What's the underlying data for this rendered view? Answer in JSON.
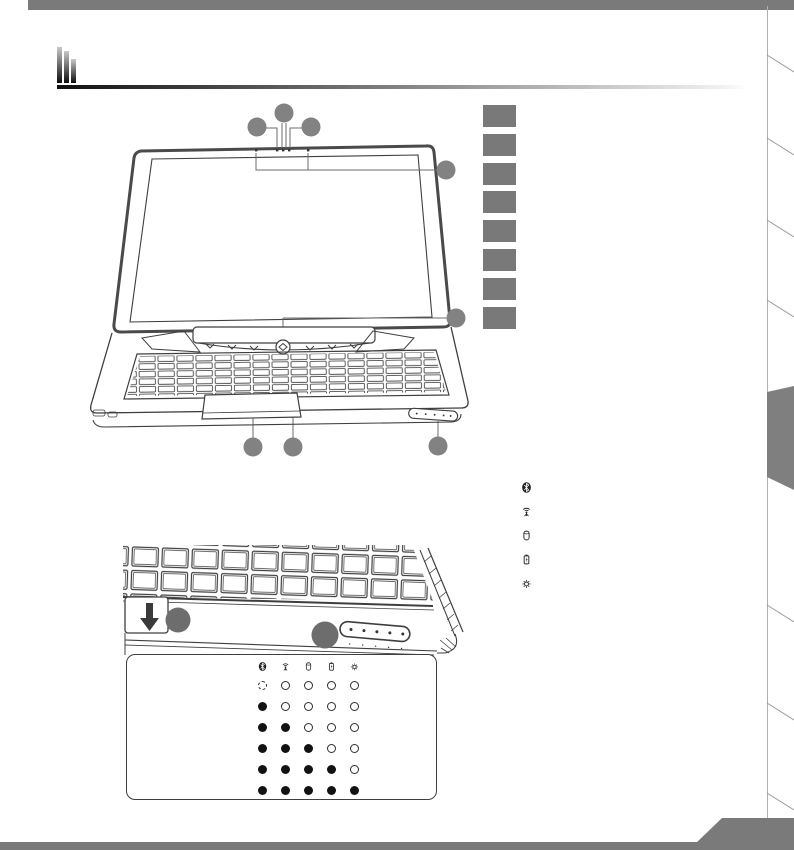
{
  "page": {
    "kind": "notebook-manual-diagram-page",
    "language": "none-visible-text"
  },
  "colors": {
    "bar_gray": "#7a7a7a",
    "box_gray": "#797979",
    "callout_gray": "#828282",
    "callout_dark_gray": "#6d6d6d",
    "line": "#3f3f3f"
  },
  "label_boxes": {
    "count": 8
  },
  "legend": {
    "icons": [
      {
        "id": "bluetooth"
      },
      {
        "id": "wireless-lan"
      },
      {
        "id": "hard-disk"
      },
      {
        "id": "battery-charging"
      },
      {
        "id": "brightness"
      }
    ]
  },
  "callouts": {
    "top_view_count": 8,
    "front_view_count": 2
  },
  "led_table": {
    "columns": [
      "bluetooth",
      "wireless-lan",
      "hard-disk",
      "battery-charging",
      "brightness"
    ],
    "rows": [
      [
        "blink",
        "off",
        "off",
        "off",
        "off"
      ],
      [
        "on",
        "off",
        "off",
        "off",
        "off"
      ],
      [
        "on",
        "on",
        "off",
        "off",
        "off"
      ],
      [
        "on",
        "on",
        "on",
        "off",
        "off"
      ],
      [
        "on",
        "on",
        "on",
        "on",
        "off"
      ],
      [
        "on",
        "on",
        "on",
        "on",
        "on"
      ]
    ]
  }
}
